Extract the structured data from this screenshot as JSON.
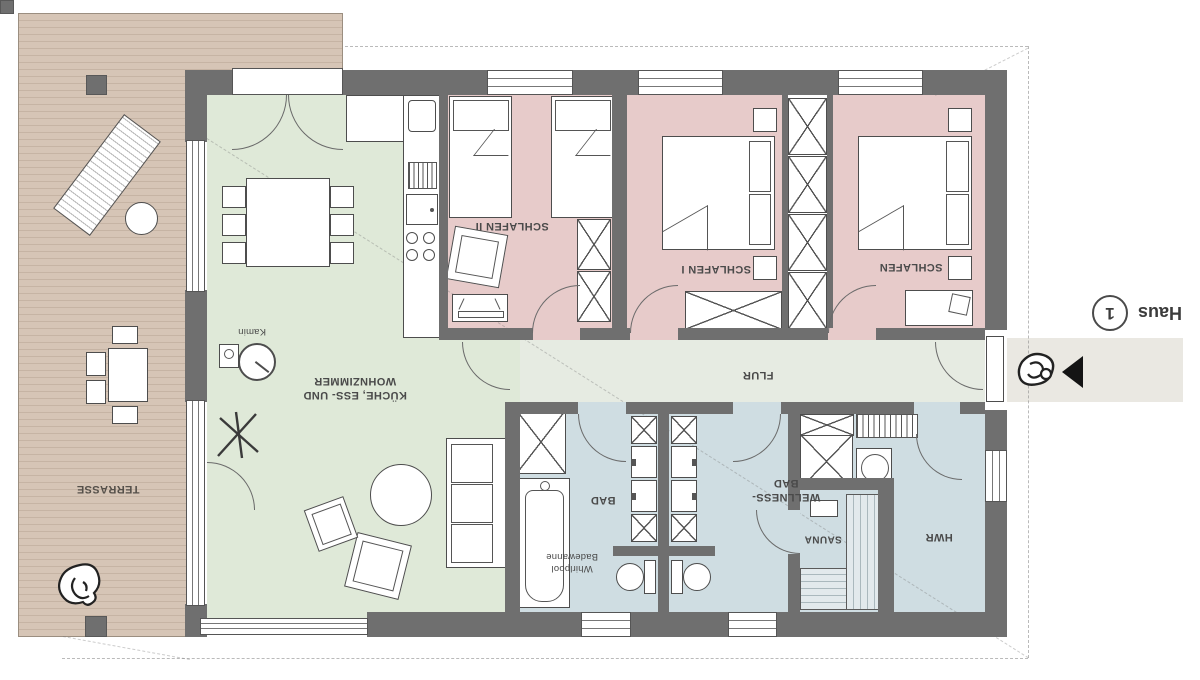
{
  "floorplan": {
    "labels": {
      "terrasse": "TERRASSE",
      "kitchen_line1": "KÜCHE, ESS- UND",
      "kitchen_line2": "WOHNZIMMER",
      "kamin": "Kamin",
      "schlafen2": "SCHLAFEN II",
      "schlafen1": "SCHLAFEN I",
      "schlafen": "SCHLAFEN",
      "flur": "FLUR",
      "bad": "BAD",
      "whirlpool_line1": "Whirlpool",
      "whirlpool_line2": "Badewanne",
      "wellness_line1": "WELLNESS-",
      "wellness_line2": "BAD",
      "sauna": "SAUNA",
      "hwr": "HWR"
    },
    "haus_badge": {
      "text": "Haus",
      "number": "1"
    },
    "colors": {
      "deck": "#d0bfb0",
      "living": "#dfe9d8",
      "bedroom": "#e7cbca",
      "hallway": "#e6ebe2",
      "bath": "#cfdde2",
      "wall": "#6f6f6f",
      "entry_walk": "#eae8e2",
      "line": "#4d4d4d"
    },
    "icons": {
      "dog": "dog-icon",
      "person": "person-icon",
      "entrance_arrow": "entrance-arrow-icon"
    },
    "note_orientation": "all labels rendered rotated 180°"
  }
}
